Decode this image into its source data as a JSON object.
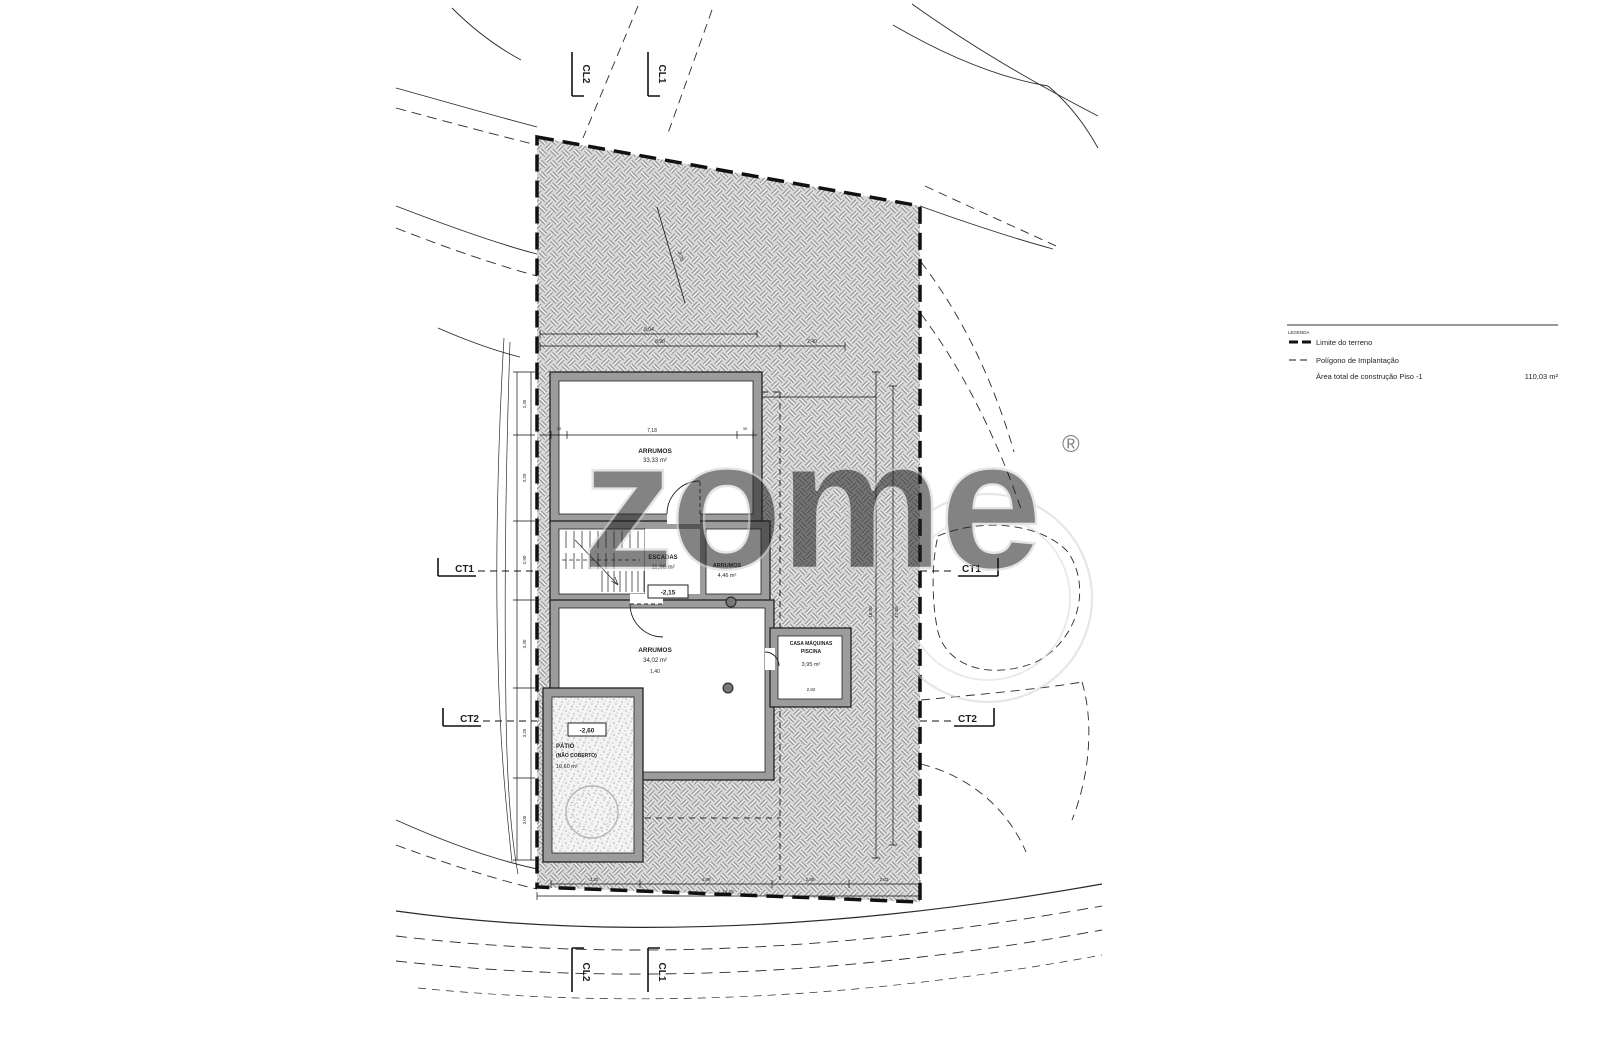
{
  "colors": {
    "paper": "#ffffff",
    "ink": "#1f1f1f",
    "hatch_bg": "#d9d9d9",
    "hatch_dark": "#8f8f8f",
    "hatch_light": "#f0f0f0",
    "wall_fill": "#9c9c9c",
    "watermark": "#d2d2d2"
  },
  "legend": {
    "heading": "LEGENDA",
    "items": [
      {
        "label": "Limite do terreno"
      },
      {
        "label": "Polígono de Implantação"
      },
      {
        "label": "Área total de construção Piso -1",
        "value": "110,03 m²"
      }
    ]
  },
  "markers": {
    "ct1": "CT1",
    "ct2": "CT2",
    "cl1": "CL1",
    "cl2": "CL2"
  },
  "rooms": {
    "storage_top": {
      "line1": "ARRUMOS",
      "area": "33,33 m²"
    },
    "stairs": {
      "line1": "ESCADAS",
      "area": "11,96 m²"
    },
    "storage_small": {
      "line1": "ARRUMOS",
      "area": "4,46 m²"
    },
    "storage_main": {
      "line1": "ARRUMOS",
      "area": "34,02 m²"
    },
    "pool_plant": {
      "line1": "CASA MÁQUINAS",
      "line2": "PISCINA",
      "area": "3,95 m²"
    },
    "patio": {
      "line1": "PÁTIO",
      "line2": "(NÃO COBERTO)",
      "area": "10,60 m²"
    }
  },
  "levels": {
    "stairs": "-2,15",
    "patio": "-2,60"
  },
  "dims": {
    "top_a": "8,04",
    "top_b": "8,90",
    "top_c": "2,40",
    "room_a": "7,18",
    "room_a_end_l": "30",
    "room_a_end_r": "30",
    "diag": "3,70",
    "room_c": "1,40",
    "annex": "2,82",
    "left": [
      "2,35",
      "3,20",
      "2,90",
      "3,30",
      "3,25",
      "3,05"
    ],
    "right": [
      "18,00",
      "17,58"
    ],
    "bottom": [
      "3,30",
      "4,89",
      "2,85",
      "2,63"
    ],
    "bottom_total": "14,19"
  },
  "watermark": {
    "text": "zome",
    "reg": "®"
  }
}
